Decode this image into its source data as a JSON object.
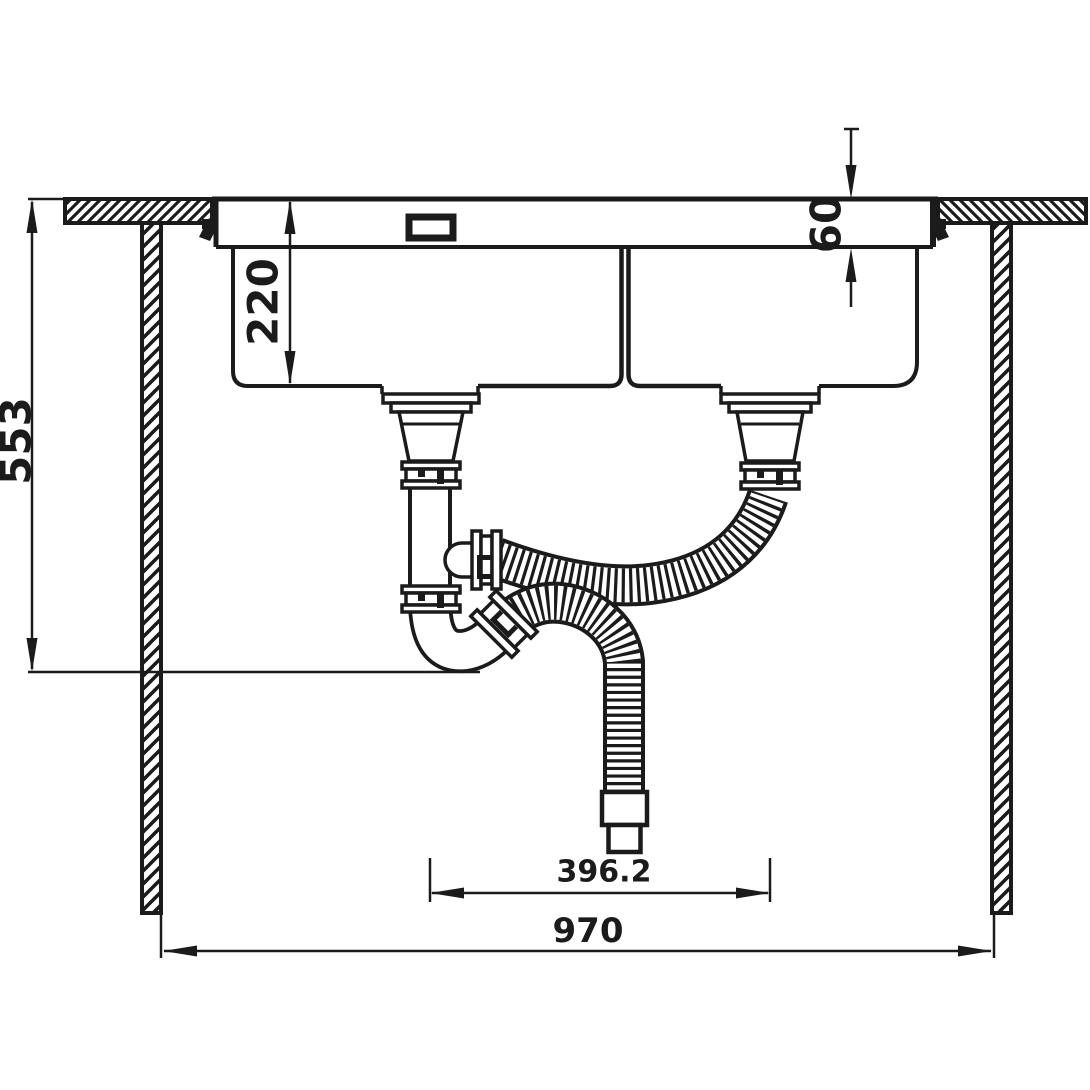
{
  "diagram": {
    "type": "technical_drawing",
    "subject": "Cross-section installation drawing of a double-bowl sink in a countertop with bottle-trap drain and two corrugated flex hoses",
    "background_color": "#ffffff",
    "line_color": "#1b1b1b",
    "dimensions": {
      "countertop_to_trap": "553",
      "bowl_depth": "220",
      "rim_height": "60",
      "drain_spacing": "396.2",
      "cabinet_width": "970"
    }
  }
}
